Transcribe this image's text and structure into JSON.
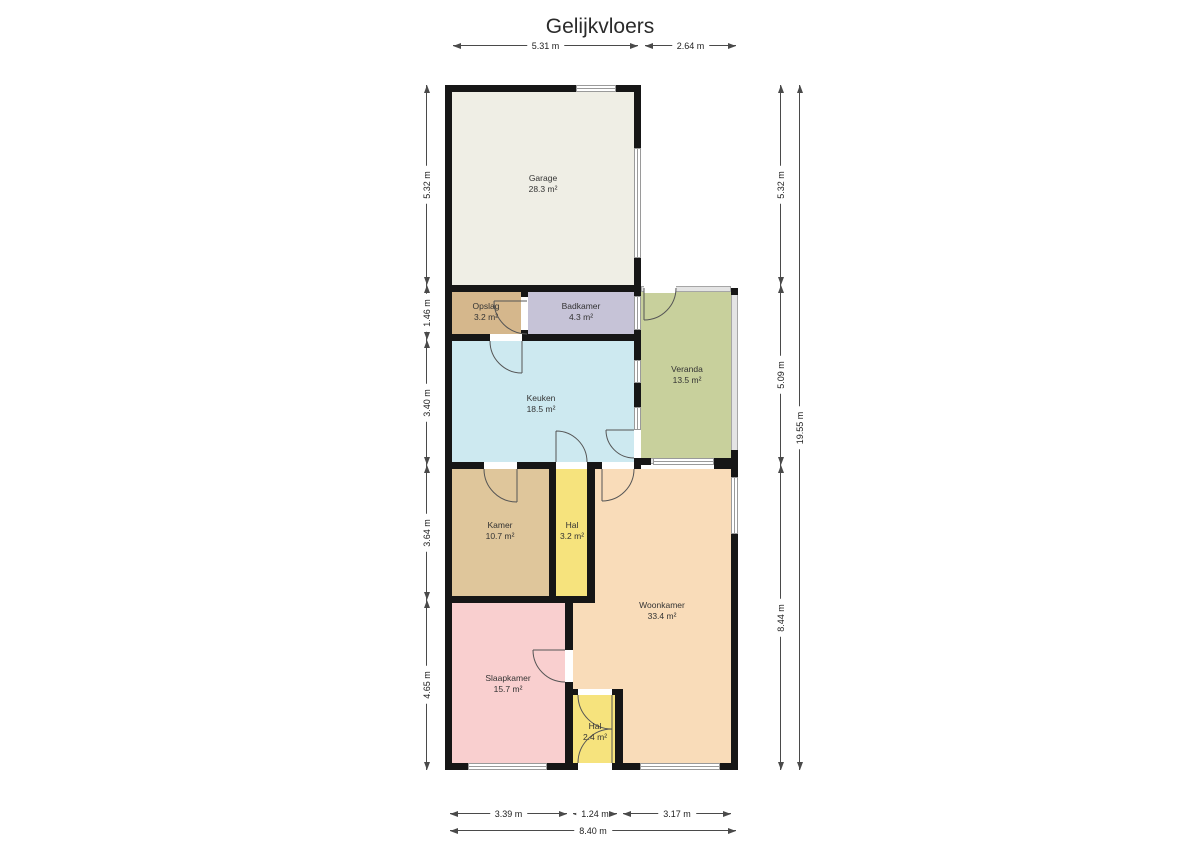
{
  "title": "Gelijkvloers",
  "wall_color": "#161616",
  "window_frame_color": "#9a9a9a",
  "door_arc_color": "#555555",
  "dimension_color": "#4a4a4a",
  "rooms": {
    "garage": {
      "name": "Garage",
      "area": "28.3 m²",
      "color": "#efeee5"
    },
    "opslag": {
      "name": "Opslag",
      "area": "3.2 m²",
      "color": "#d5b78c"
    },
    "badkamer": {
      "name": "Badkamer",
      "area": "4.3 m²",
      "color": "#c6c3d7"
    },
    "veranda": {
      "name": "Veranda",
      "area": "13.5 m²",
      "color": "#c8d09c"
    },
    "keuken": {
      "name": "Keuken",
      "area": "18.5 m²",
      "color": "#cde9f0"
    },
    "kamer": {
      "name": "Kamer",
      "area": "10.7 m²",
      "color": "#dfc69b"
    },
    "hal_mid": {
      "name": "Hal",
      "area": "3.2 m²",
      "color": "#f6e37d"
    },
    "woonkamer": {
      "name": "Woonkamer",
      "area": "33.4 m²",
      "color": "#f9dcb9"
    },
    "slaapkamer": {
      "name": "Slaapkamer",
      "area": "15.7 m²",
      "color": "#f9cfcf"
    },
    "hal_bottom": {
      "name": "Hal",
      "area": "2.4 m²",
      "color": "#f6e37d"
    }
  },
  "dimensions": {
    "top": [
      "5.31 m",
      "2.64 m"
    ],
    "left": [
      "5.32 m",
      "1.46 m",
      "3.40 m",
      "3.64 m",
      "4.65 m"
    ],
    "right": [
      "5.32 m",
      "5.09 m",
      "8.44 m"
    ],
    "right_total": "19.55 m",
    "bottom": [
      "3.39 m",
      "1.24 m",
      "3.17 m"
    ],
    "bottom_total": "8.40 m"
  }
}
